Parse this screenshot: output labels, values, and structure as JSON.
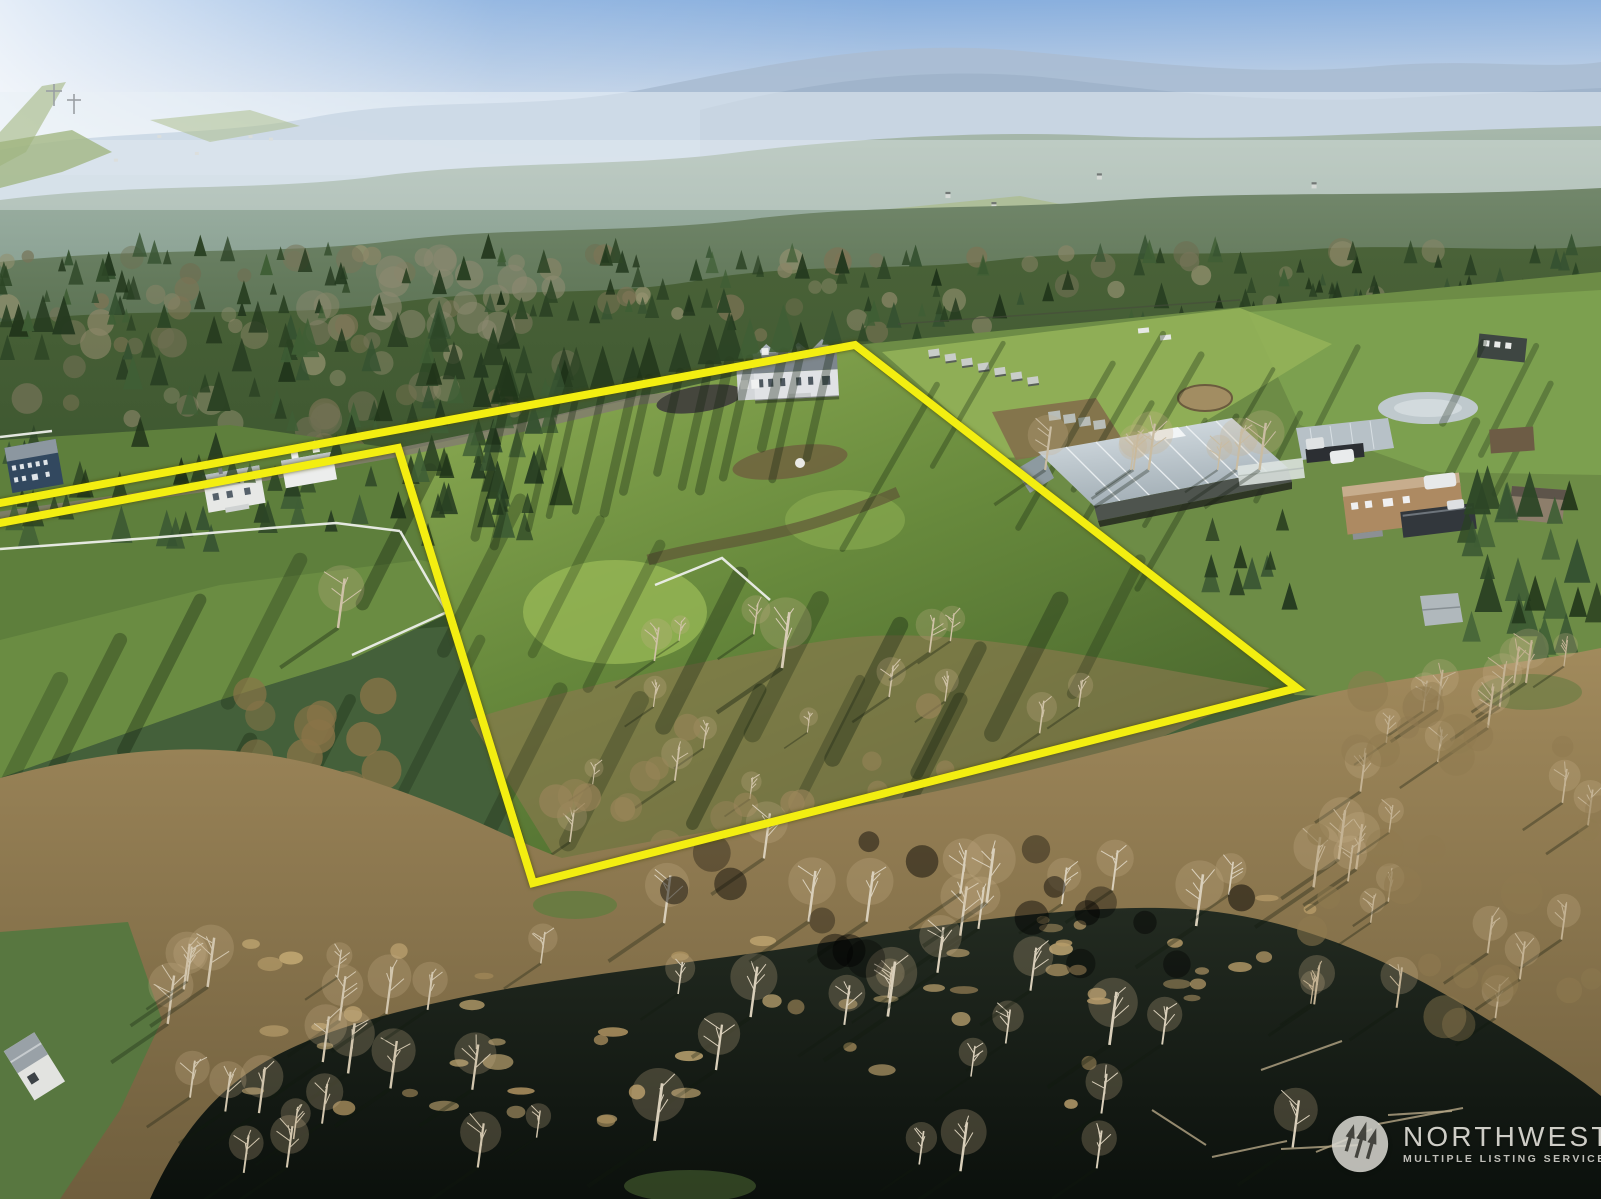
{
  "photo": {
    "kind": "aerial-drone-photo",
    "scene": "wooded rural acreage with a yellow-outlined parcel, homes, barn, pastures, and a dark wetland pond with bare trees in the foreground"
  },
  "boundary_overlay": {
    "color": "#f3ee11",
    "stroke_width": 8,
    "points": "0,503 855,345 1297,688 533,883 398,448 0,523"
  },
  "watermark": {
    "brand": "NORTHWEST",
    "tagline": "MULTIPLE LISTING SERVICE®",
    "logo_icon": "three-pines-circle",
    "color": "rgba(233,231,224,0.88)"
  },
  "palette": {
    "sky": "#7fa9dc",
    "haze": "#e4ecf2",
    "distant_ridge": "#aabdd3",
    "far_forest": "#8ba294",
    "conifer_dark": "#2c4323",
    "field_sunlit": "#8fae55",
    "field_shadow": "#46632c",
    "marsh_brush": "#9b8254",
    "bare_tree": "#d8cdb6",
    "pond_water": "#11160f",
    "metal_roof": "#c6d0d6"
  }
}
